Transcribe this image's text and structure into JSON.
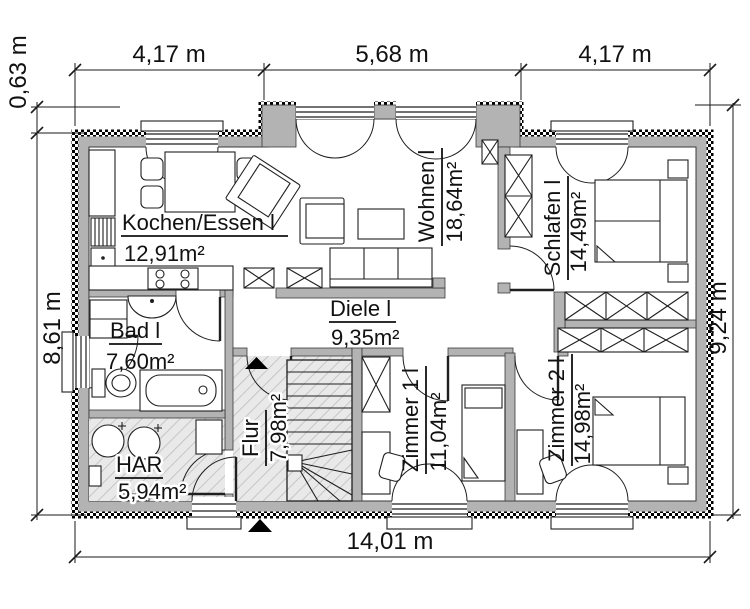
{
  "title": "Grundriss Erdgeschoss (floor plan)",
  "colors": {
    "wall": "#b3b3b3",
    "outline": "#1a1a1a",
    "hatch_floor": "#e9e9e9",
    "background": "#ffffff"
  },
  "icons": {
    "entrance_arrow": "black triangle up",
    "stair_direction_arrow": "black triangle up"
  },
  "dimensions": {
    "top": [
      "4,17 m",
      "5,68 m",
      "4,17 m"
    ],
    "left_upper": "0,63 m",
    "left": "8,61 m",
    "right": "9,24 m",
    "bottom": "14,01 m"
  },
  "rooms": [
    {
      "id": "kochen_essen",
      "name": "Kochen/Essen l",
      "area": "12,91m²"
    },
    {
      "id": "wohnen",
      "name": "Wohnen l",
      "area": "18,64m²"
    },
    {
      "id": "schlafen",
      "name": "Schlafen l",
      "area": "14,49m²"
    },
    {
      "id": "bad",
      "name": "Bad l",
      "area": "7,60m²"
    },
    {
      "id": "diele",
      "name": "Diele l",
      "area": "9,35m²"
    },
    {
      "id": "flur",
      "name": "Flur",
      "area": "7,98m²"
    },
    {
      "id": "har",
      "name": "HAR",
      "area": "5,94m²"
    },
    {
      "id": "zimmer1",
      "name": "Zimmer 1 l",
      "area": "11,04m²"
    },
    {
      "id": "zimmer2",
      "name": "Zimmer 2 l",
      "area": "14,98m²"
    }
  ]
}
